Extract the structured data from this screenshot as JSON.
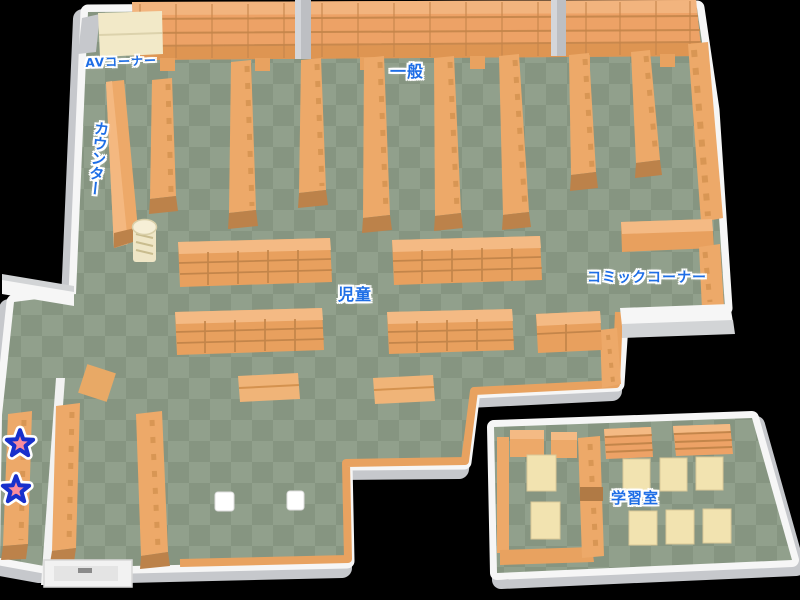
{
  "map": {
    "areas": {
      "av_corner": {
        "label": "AVコーナー"
      },
      "general": {
        "label": "一般"
      },
      "counter": {
        "label": "カウンター"
      },
      "children": {
        "label": "児童"
      },
      "comic_corner": {
        "label": "コミックコーナー"
      },
      "study_room": {
        "label": "学習室"
      }
    },
    "markers": {
      "star_count": 2,
      "star_icon": "star-marker"
    },
    "colors": {
      "background": "#000000",
      "floor_light": "#91A08C",
      "floor_dark": "#869581",
      "wall_white": "#F6F6F6",
      "wall_gray": "#C6C8CC",
      "shelf_orange": "#EDA969",
      "shelf_orange_light": "#F4B880",
      "shelf_end_cap": "#BC824A",
      "shelf_grid_line": "#C3854A",
      "carpet_trim": "#E8A260",
      "table_cream": "#F2E3B0",
      "desk_cream": "#F2E9C8",
      "label_blue": "#1E6EE6",
      "star_pink": "#F98C9C",
      "star_outline": "#1830CC"
    }
  }
}
